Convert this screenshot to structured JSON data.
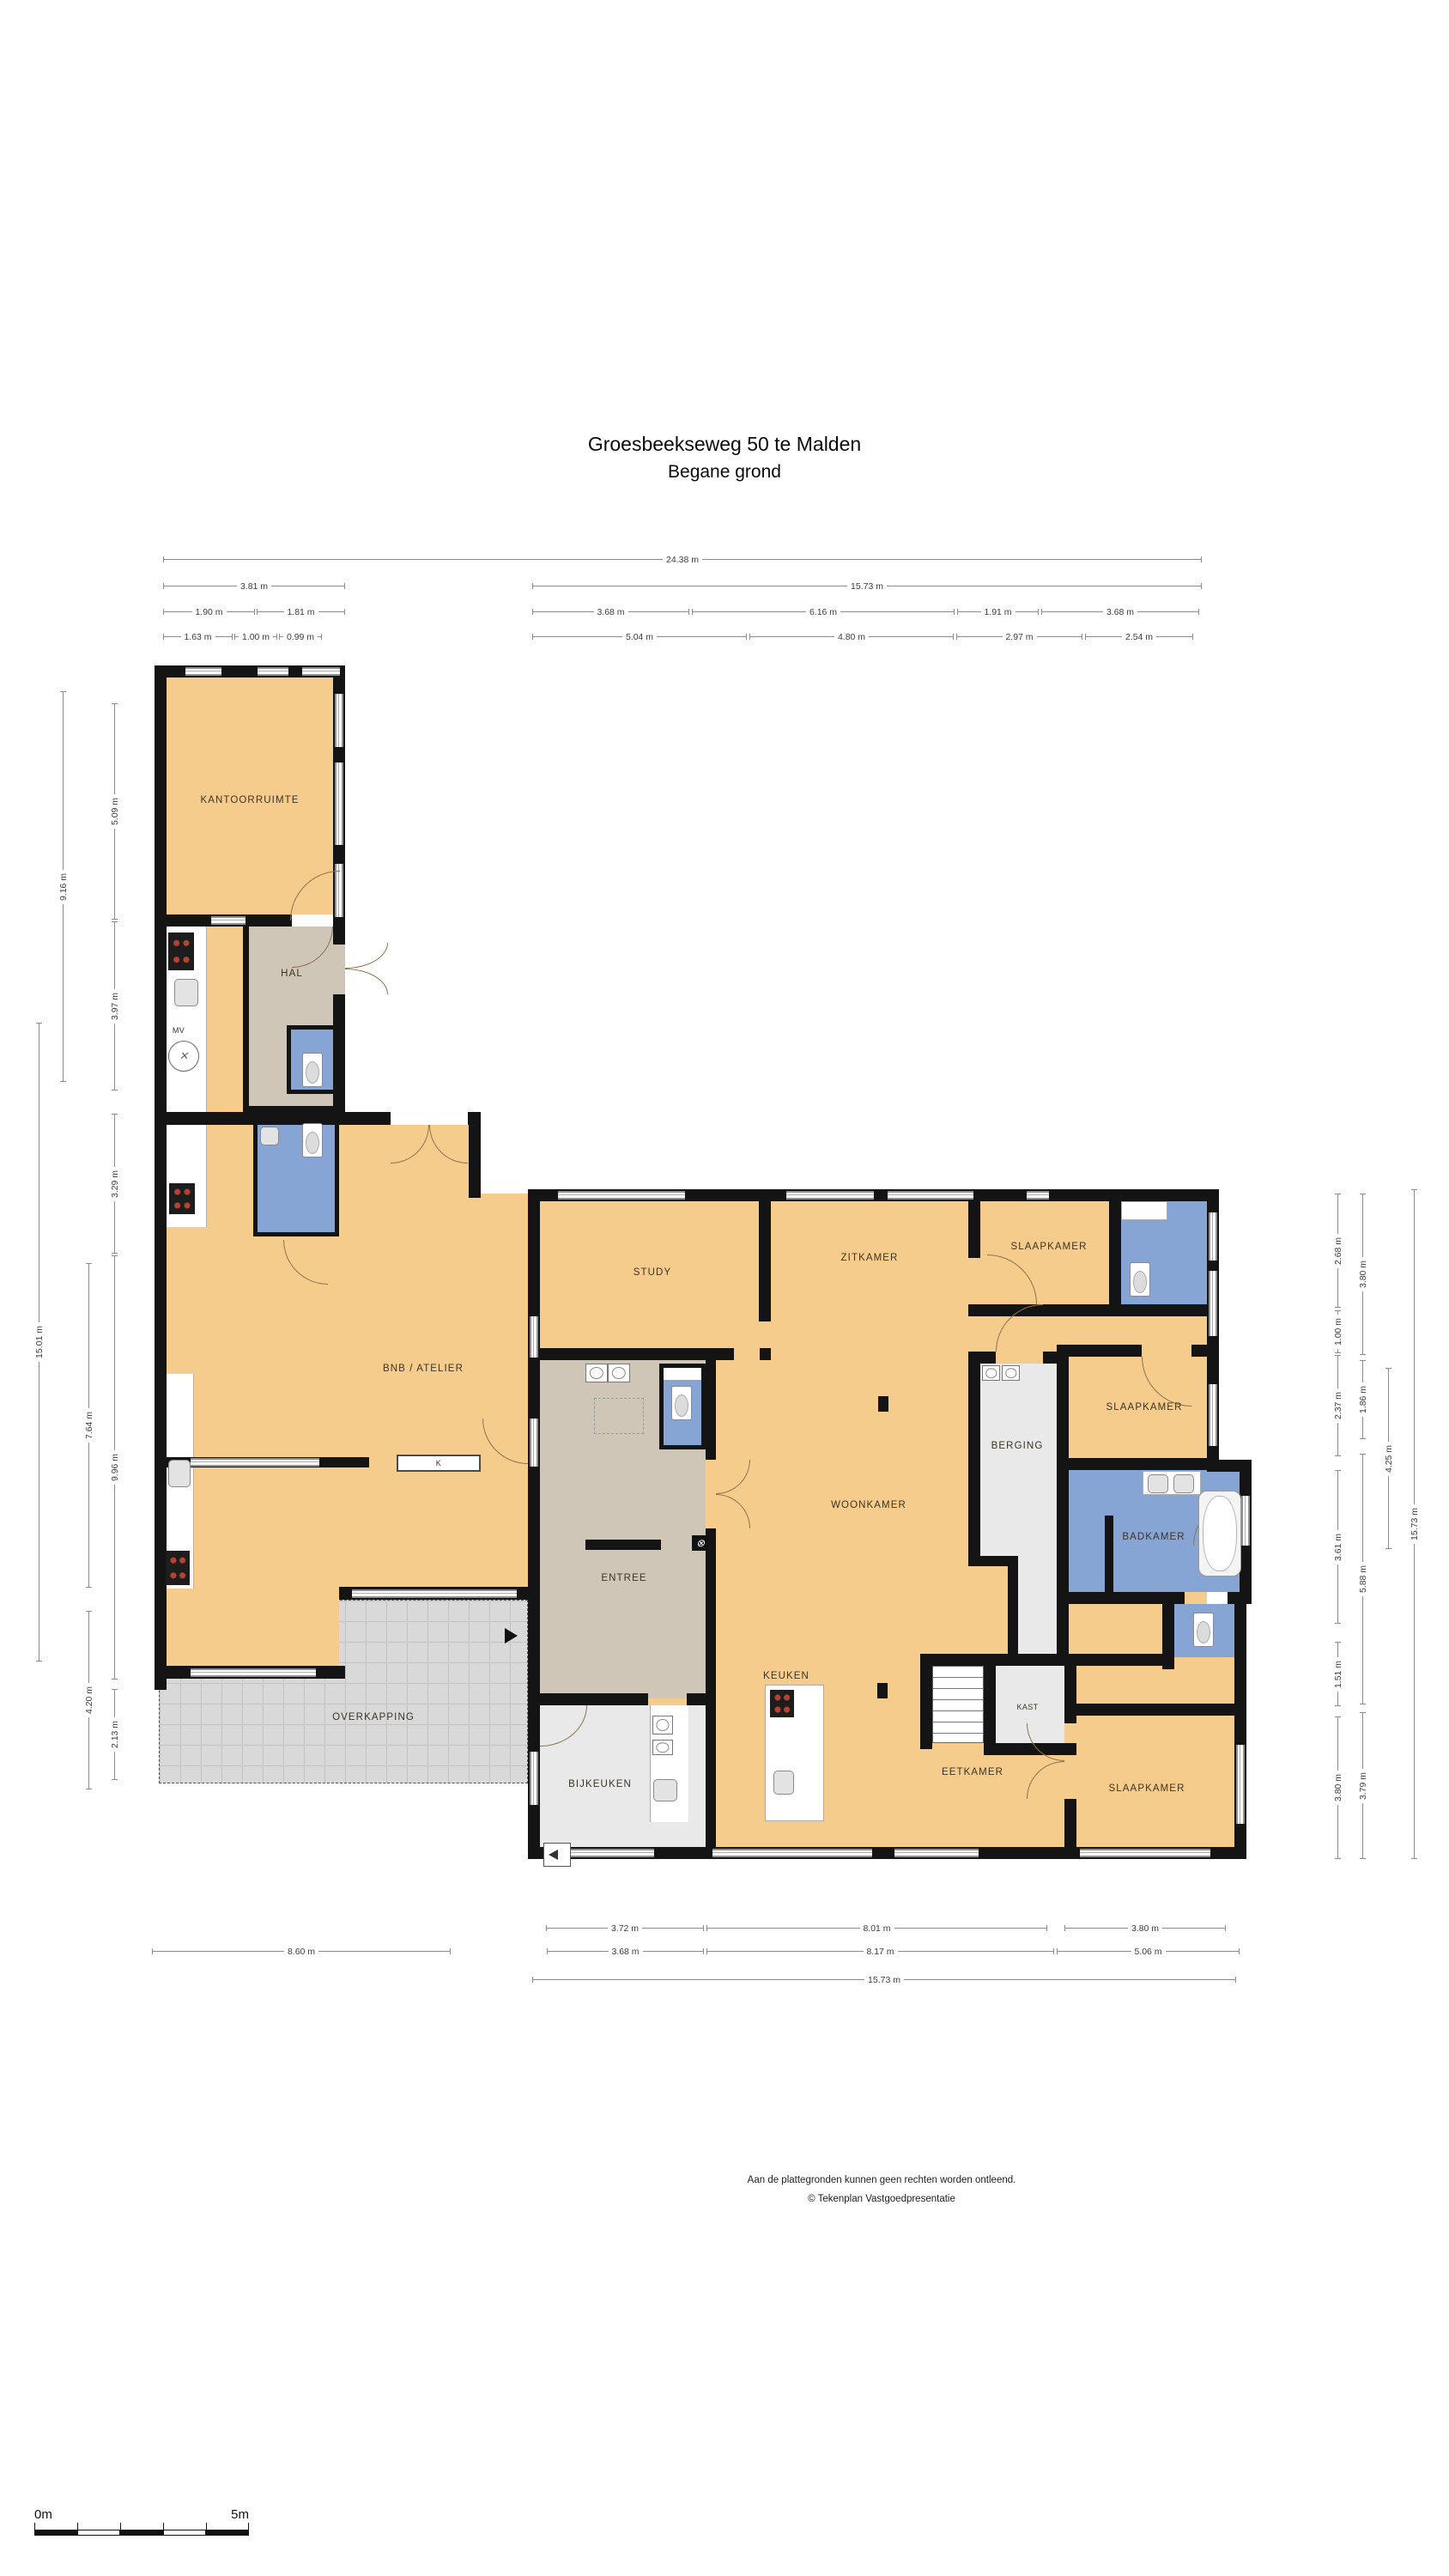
{
  "title": {
    "line1": "Groesbeekseweg 50 te Malden",
    "line2": "Begane grond"
  },
  "plan": {
    "room_labels": [
      {
        "id": "kantoorruimte",
        "text": "KANTOORRUIMTE"
      },
      {
        "id": "hal",
        "text": "HAL"
      },
      {
        "id": "mv",
        "text": "MV"
      },
      {
        "id": "bnb-atelier",
        "text": "BNB / ATELIER"
      },
      {
        "id": "k",
        "text": "K"
      },
      {
        "id": "overkapping",
        "text": "OVERKAPPING"
      },
      {
        "id": "study",
        "text": "STUDY"
      },
      {
        "id": "zitkamer",
        "text": "ZITKAMER"
      },
      {
        "id": "slaapkamer-1",
        "text": "SLAAPKAMER"
      },
      {
        "id": "slaapkamer-2",
        "text": "SLAAPKAMER"
      },
      {
        "id": "berging",
        "text": "BERGING"
      },
      {
        "id": "badkamer",
        "text": "BADKAMER"
      },
      {
        "id": "woonkamer",
        "text": "WOONKAMER"
      },
      {
        "id": "entree",
        "text": "ENTREE"
      },
      {
        "id": "keuken",
        "text": "KEUKEN"
      },
      {
        "id": "bijkeuken",
        "text": "BIJKEUKEN"
      },
      {
        "id": "eetkamer",
        "text": "EETKAMER"
      },
      {
        "id": "kast",
        "text": "KAST"
      },
      {
        "id": "slaapkamer-3",
        "text": "SLAAPKAMER"
      }
    ]
  },
  "dimensions": {
    "top_rows": [
      [
        "24.38 m"
      ],
      [
        "3.81 m",
        "15.73 m"
      ],
      [
        "1.90 m",
        "1.81 m",
        "3.68 m",
        "6.16 m",
        "1.91 m",
        "3.68 m"
      ],
      [
        "1.63 m",
        "1.00 m",
        "0.99 m",
        "5.04 m",
        "4.80 m",
        "2.97 m",
        "2.54 m"
      ]
    ],
    "bottom_rows": [
      [
        "3.72 m",
        "8.01 m",
        "3.80 m"
      ],
      [
        "8.60 m",
        "3.68 m",
        "8.17 m",
        "5.06 m"
      ],
      [
        "15.73 m"
      ]
    ],
    "left_cols": [
      [
        "15.01 m"
      ],
      [
        "9.16 m"
      ],
      [
        "7.64 m",
        "4.20 m"
      ],
      [
        "5.09 m",
        "3.97 m",
        "3.29 m",
        "9.96 m",
        "2.13 m"
      ]
    ],
    "right_cols": [
      [
        "2.68 m",
        "1.00 m",
        "2.37 m",
        "3.61 m",
        "1.51 m",
        "3.80 m"
      ],
      [
        "3.80 m",
        "1.86 m",
        "5.88 m",
        "3.79 m"
      ],
      [
        "4.25 m"
      ],
      [
        "15.73 m"
      ]
    ]
  },
  "footer": {
    "line1": "Aan de plattegronden kunnen geen rechten worden ontleend.",
    "line2": "© Tekenplan Vastgoedpresentatie"
  },
  "scale_bar": {
    "start_label": "0m",
    "end_label": "5m"
  },
  "colors": {
    "room_fill": "#f6cc8c",
    "hall_fill": "#cfc6b8",
    "wet_room_fill": "#87a5d4",
    "storage_fill": "#e9e9e9",
    "overkapping_fill": "#d9d9d9",
    "wall": "#141414"
  }
}
